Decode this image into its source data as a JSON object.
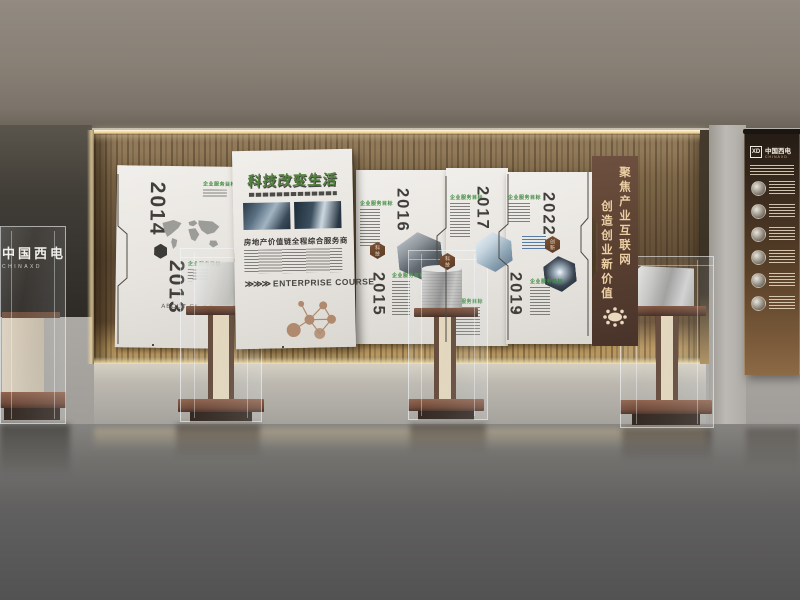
{
  "colors": {
    "accent_green": "#3f8a41",
    "title_green": "#52803e",
    "badge_brown": "#6a4430",
    "banner_brown": "#5c4232",
    "gold_text": "#ecd0a4",
    "panel_white": "#ece9e4",
    "wood_brown": "#6b5338"
  },
  "left_exhibit": {
    "brand": "中国西电",
    "brand_en": "CHINAXD"
  },
  "wall": {
    "header_label": "企业服务目标",
    "years": {
      "y2014": "2014",
      "y2013": "2013",
      "y2016": "2016",
      "y2015": "2015",
      "y2017": "2017",
      "y2022": "2022",
      "y2019": "2019"
    },
    "badges": {
      "tech": "科技",
      "innovation": "创新"
    },
    "panelA": {
      "about": "ABOUT CS"
    },
    "panelB": {
      "title": "科技改变生活",
      "tagline": "房地产价值链全程综合服务商",
      "arrows": "≫≫≫",
      "course": "ENTERPRISE COURSE"
    }
  },
  "banner": {
    "line1": "聚焦产业互联网",
    "line2": "创造创业新价值"
  },
  "rollup": {
    "logo": "XD",
    "brand": "中国西电",
    "brand_en": "CHINAXD"
  },
  "icons": {
    "world-map": "continent-silhouettes",
    "molecule-network": "connected-circles",
    "hex-node": "dark-hexagon",
    "orbit-emblem": "ellipse-with-orbiting-dots"
  }
}
